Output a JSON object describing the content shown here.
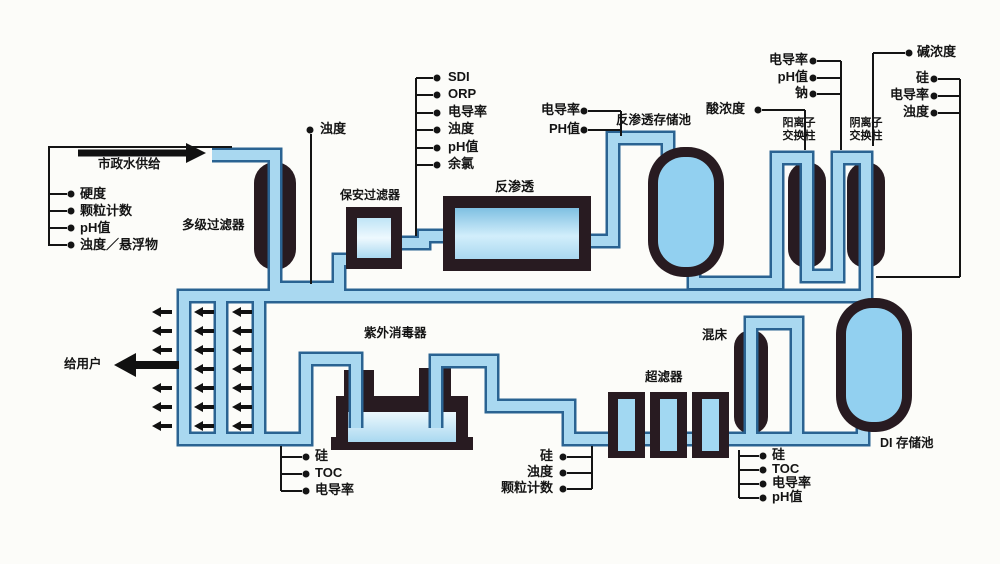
{
  "diagram": {
    "source_label": "市政水供给",
    "to_users": "给用户",
    "equipment": {
      "multistage_filter": "多级过滤器",
      "security_filter": "保安过滤器",
      "reverse_osmosis": "反渗透",
      "ro_storage_tank": "反渗透存储池",
      "cation_column": [
        "阳离子",
        "交换柱"
      ],
      "anion_column": [
        "阴离子",
        "交换柱"
      ],
      "uv_sterilizer": "紫外消毒器",
      "ultrafilter": "超滤器",
      "mixed_bed": "混床",
      "di_storage_tank": "DI 存储池"
    },
    "monitors": {
      "feed": [
        "硬度",
        "颗粒计数",
        "pH值",
        "浊度／悬浮物"
      ],
      "after_multistage": [
        "浊度"
      ],
      "pre_ro": [
        "SDI",
        "ORP",
        "电导率",
        "浊度",
        "pH值",
        "余氯"
      ],
      "post_ro": [
        "电导率",
        "PH值"
      ],
      "acid": [
        "酸浓度"
      ],
      "post_cation": [
        "电导率",
        "pH值",
        "钠"
      ],
      "alkali": [
        "碱浓度"
      ],
      "post_anion": [
        "硅",
        "电导率",
        "浊度"
      ],
      "loop_left": [
        "硅",
        "TOC",
        "电导率"
      ],
      "loop_mid": [
        "硅",
        "浊度",
        "颗粒计数"
      ],
      "loop_right": [
        "硅",
        "TOC",
        "电导率",
        "pH值"
      ]
    },
    "colors": {
      "pipe_fill": "#a9d8f0",
      "pipe_edge": "#2a6392",
      "vessel_dark": "#281b21",
      "tank_fill": "#92d0f0",
      "line": "#141414",
      "background": "#fcfcf9"
    }
  }
}
